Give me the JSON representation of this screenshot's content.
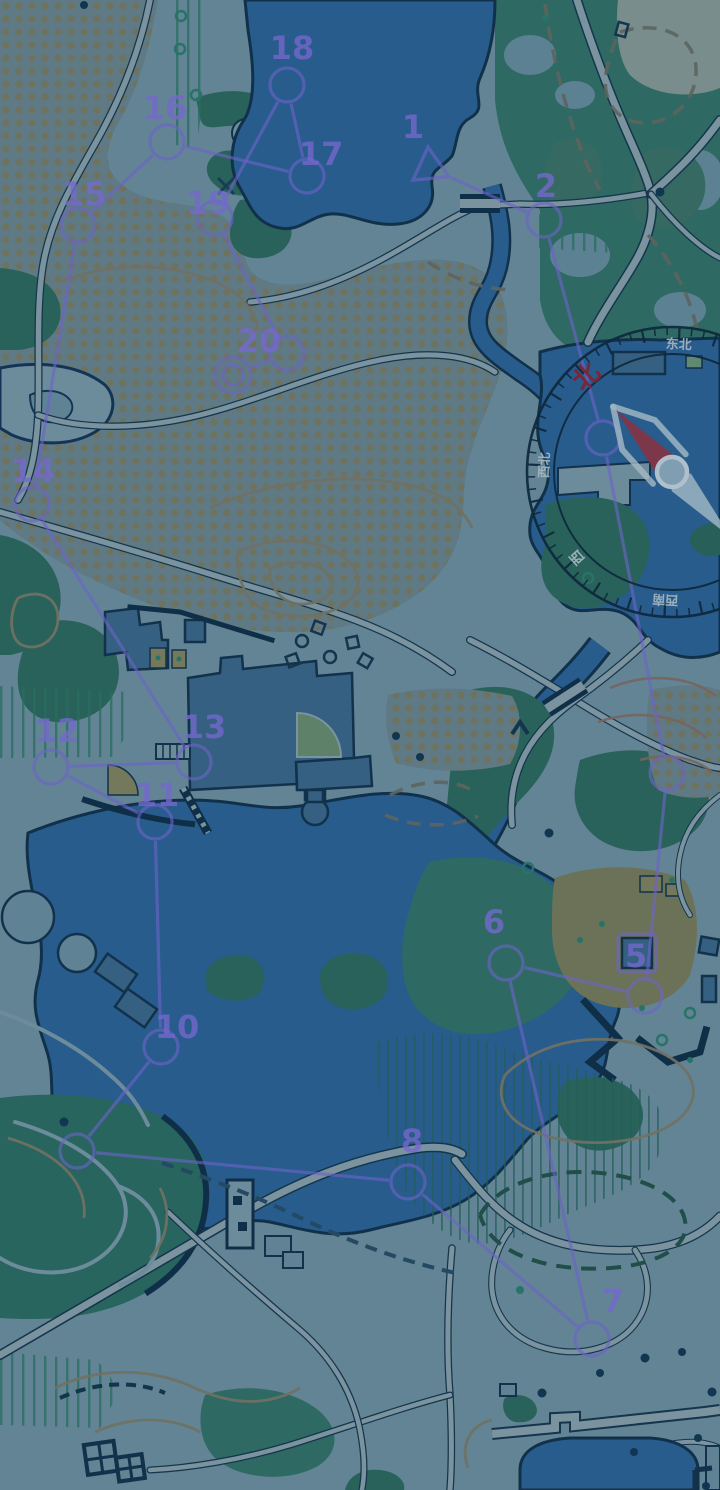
{
  "screen": {
    "width": 720,
    "height": 1490,
    "scene": "tinted orienteering park map with course overlay and compass"
  },
  "palette": {
    "course_purple": "rgba(128,112,226,0.62)",
    "course_label_purple": "rgba(136,118,232,0.8)",
    "water_blue": "#2d679b",
    "forest_teal": "#2f6e60",
    "building_blue": "#3d6c8e",
    "compass_ring": "#0e2a3d",
    "compass_north_red": "#97232e",
    "compass_label_light": "#c3d2da",
    "needle_red": "#a53340",
    "needle_light": "#c6d8e2",
    "tint_overlay": "#0c2440"
  },
  "course": {
    "start": {
      "x": 430,
      "y": 168
    },
    "finish": {
      "x": 233,
      "y": 375
    },
    "marker_square": {
      "x": 618,
      "y": 934,
      "size": 38
    },
    "controls": [
      {
        "n": "1",
        "x": 430,
        "y": 168,
        "type": "start",
        "lx": 413,
        "ly": 126
      },
      {
        "n": "2",
        "x": 544,
        "y": 220,
        "lx": 546,
        "ly": 185
      },
      {
        "n": "3",
        "x": 603,
        "y": 438
      },
      {
        "n": "4",
        "x": 667,
        "y": 773
      },
      {
        "n": "5",
        "x": 645,
        "y": 996,
        "lx": 636,
        "ly": 955
      },
      {
        "n": "6",
        "x": 506,
        "y": 963,
        "lx": 494,
        "ly": 921
      },
      {
        "n": "7",
        "x": 592,
        "y": 1339,
        "lx": 613,
        "ly": 1300
      },
      {
        "n": "8",
        "x": 408,
        "y": 1182,
        "lx": 412,
        "ly": 1140
      },
      {
        "n": "9",
        "x": 77,
        "y": 1151
      },
      {
        "n": "10",
        "x": 161,
        "y": 1047,
        "lx": 177,
        "ly": 1026
      },
      {
        "n": "11",
        "x": 155,
        "y": 822,
        "lx": 157,
        "ly": 794
      },
      {
        "n": "12",
        "x": 51,
        "y": 767,
        "lx": 57,
        "ly": 730
      },
      {
        "n": "13",
        "x": 194,
        "y": 762,
        "lx": 204,
        "ly": 726
      },
      {
        "n": "14",
        "x": 32,
        "y": 504,
        "lx": 33,
        "ly": 470
      },
      {
        "n": "15",
        "x": 78,
        "y": 225,
        "lx": 84,
        "ly": 193
      },
      {
        "n": "16",
        "x": 167,
        "y": 142,
        "lx": 165,
        "ly": 107
      },
      {
        "n": "17",
        "x": 307,
        "y": 176,
        "lx": 321,
        "ly": 153
      },
      {
        "n": "18",
        "x": 287,
        "y": 85,
        "lx": 292,
        "ly": 47
      },
      {
        "n": "19",
        "x": 215,
        "y": 218,
        "lx": 208,
        "ly": 202
      },
      {
        "n": "20",
        "x": 287,
        "y": 353,
        "lx": 259,
        "ly": 340
      }
    ]
  },
  "compass": {
    "cx": 672,
    "cy": 472,
    "rotation": -42,
    "r_outer": 145,
    "r_inner": 118,
    "label_radius": 127,
    "labels": [
      {
        "text": "北",
        "bearing": 0,
        "color": "#97232e",
        "size": 26
      },
      {
        "text": "东北",
        "bearing": 45,
        "color": "#c3d2da",
        "size": 13
      },
      {
        "text": "西南",
        "bearing": 225,
        "color": "#c3d2da",
        "size": 13
      },
      {
        "text": "西",
        "bearing": 270,
        "color": "#c3d2da",
        "size": 14
      },
      {
        "text": "西北",
        "bearing": 315,
        "color": "#c3d2da",
        "size": 13
      }
    ]
  }
}
